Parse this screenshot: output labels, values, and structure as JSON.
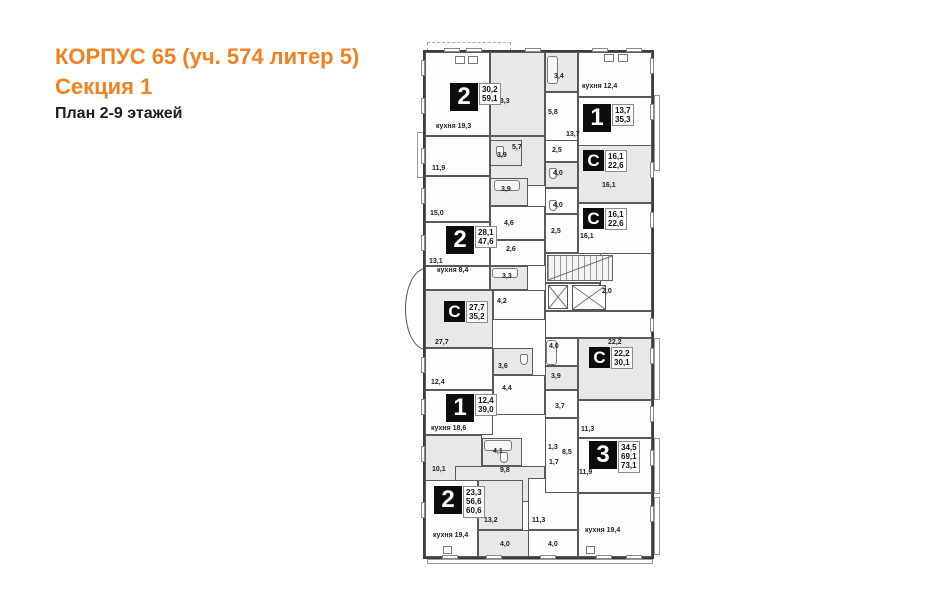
{
  "header": {
    "line1": "КОРПУС 65 (уч. 574 литер 5)",
    "line2": "Секция 1",
    "line3": "План 2-9 этажей",
    "accent_color": "#f48120"
  },
  "plan": {
    "wall_color": "#5a5a5a",
    "fill_gray": "#e8e8e8",
    "fill_white": "#fdfdfd",
    "badge_color": "#0c0c0c",
    "outline": [
      423,
      50,
      231,
      509
    ],
    "bay": [
      405,
      268,
      21,
      82
    ],
    "rooms": [
      [
        425,
        52,
        65,
        84,
        "w",
        "room-kitchen-19-3"
      ],
      [
        490,
        52,
        55,
        84,
        "g",
        "room-18-3"
      ],
      [
        490,
        136,
        55,
        50,
        "g",
        "hall-5-7"
      ],
      [
        425,
        136,
        65,
        40,
        "w",
        "room-11-9"
      ],
      [
        425,
        176,
        65,
        46,
        "w",
        "room-15-0"
      ],
      [
        425,
        222,
        65,
        44,
        "w",
        "room-13-1"
      ],
      [
        425,
        266,
        65,
        24,
        "w",
        "room-kitchen-8-4"
      ],
      [
        490,
        140,
        32,
        26,
        "g",
        "bath-3-9a"
      ],
      [
        490,
        178,
        38,
        28,
        "g",
        "bath-3-9b"
      ],
      [
        490,
        206,
        55,
        34,
        "w",
        "hall-4-6"
      ],
      [
        490,
        240,
        55,
        26,
        "w",
        "room-2-6"
      ],
      [
        490,
        266,
        38,
        24,
        "g",
        "bath-3-3"
      ],
      [
        425,
        290,
        68,
        58,
        "g",
        "studio-27-7"
      ],
      [
        493,
        290,
        52,
        30,
        "w",
        "hall-4-2"
      ],
      [
        493,
        348,
        40,
        27,
        "g",
        "bath-3-6"
      ],
      [
        425,
        348,
        68,
        42,
        "w",
        "room-12-4"
      ],
      [
        425,
        390,
        68,
        45,
        "w",
        "room-39-0"
      ],
      [
        493,
        375,
        52,
        40,
        "w",
        "hall-4-4"
      ],
      [
        425,
        435,
        57,
        50,
        "g",
        "room-10-1"
      ],
      [
        482,
        438,
        40,
        28,
        "g",
        "bath-4-1"
      ],
      [
        455,
        466,
        90,
        36,
        "g",
        "hall-9-8"
      ],
      [
        425,
        480,
        53,
        77,
        "w",
        "room-56-6"
      ],
      [
        478,
        480,
        45,
        50,
        "g",
        "room-13-2"
      ],
      [
        478,
        530,
        68,
        27,
        "g",
        "hall-4-0-left"
      ],
      [
        528,
        478,
        50,
        52,
        "w",
        "room-11-3b"
      ],
      [
        528,
        530,
        50,
        27,
        "w",
        "hall-4-0-right"
      ],
      [
        578,
        493,
        74,
        64,
        "w",
        "room-kitchen-19-4-right"
      ],
      [
        545,
        52,
        33,
        40,
        "g",
        "bath-3-4"
      ],
      [
        578,
        52,
        74,
        45,
        "w",
        "room-kitchen-12-4"
      ],
      [
        545,
        92,
        33,
        64,
        "w",
        "hall-5-8"
      ],
      [
        578,
        97,
        74,
        60,
        "w",
        "room-13-7"
      ],
      [
        545,
        140,
        33,
        22,
        "w",
        "hall-2-5a"
      ],
      [
        545,
        162,
        33,
        26,
        "g",
        "bath-4-0a"
      ],
      [
        578,
        145,
        74,
        58,
        "g",
        "studio-16-1a"
      ],
      [
        545,
        188,
        33,
        26,
        "w",
        "bath-4-0b"
      ],
      [
        545,
        214,
        33,
        39,
        "w",
        "hall-2-5b"
      ],
      [
        578,
        203,
        74,
        52,
        "w",
        "studio-16-1b"
      ],
      [
        545,
        253,
        70,
        30,
        "w",
        "stair-room"
      ],
      [
        600,
        253,
        52,
        58,
        "w",
        "corridor-2-0"
      ],
      [
        545,
        283,
        55,
        28,
        "w",
        "elevator-lobby"
      ],
      [
        545,
        311,
        107,
        27,
        "w",
        "lobby-strip"
      ],
      [
        578,
        338,
        74,
        62,
        "g",
        "studio-22-2"
      ],
      [
        545,
        338,
        33,
        28,
        "w",
        "bath-4-0c"
      ],
      [
        545,
        366,
        33,
        24,
        "g",
        "bath-3-9c"
      ],
      [
        545,
        390,
        33,
        28,
        "w",
        "bath-3-7"
      ],
      [
        578,
        400,
        74,
        38,
        "w",
        "room-11-3a"
      ],
      [
        545,
        418,
        33,
        75,
        "w",
        "hall-8-5"
      ],
      [
        578,
        438,
        74,
        55,
        "w",
        "room-73-1"
      ]
    ],
    "badges": [
      {
        "x": 450,
        "y": 83,
        "ch": "2",
        "small": false,
        "vals": [
          "30,2",
          "59,1"
        ]
      },
      {
        "x": 583,
        "y": 104,
        "ch": "1",
        "small": false,
        "vals": [
          "13,7",
          "35,3"
        ]
      },
      {
        "x": 583,
        "y": 150,
        "ch": "С",
        "small": true,
        "vals": [
          "16,1",
          "22,6"
        ]
      },
      {
        "x": 583,
        "y": 208,
        "ch": "С",
        "small": true,
        "vals": [
          "16,1",
          "22,6"
        ]
      },
      {
        "x": 446,
        "y": 226,
        "ch": "2",
        "small": false,
        "vals": [
          "28,1",
          "47,6"
        ]
      },
      {
        "x": 444,
        "y": 301,
        "ch": "С",
        "small": true,
        "vals": [
          "27,7",
          "35,2"
        ]
      },
      {
        "x": 589,
        "y": 347,
        "ch": "С",
        "small": true,
        "vals": [
          "22,2",
          "30,1"
        ]
      },
      {
        "x": 446,
        "y": 394,
        "ch": "1",
        "small": false,
        "vals": [
          "12,4",
          "39,0"
        ]
      },
      {
        "x": 589,
        "y": 441,
        "ch": "3",
        "small": false,
        "vals": [
          "34,5",
          "69,1",
          "73,1"
        ]
      },
      {
        "x": 434,
        "y": 486,
        "ch": "2",
        "small": false,
        "vals": [
          "23,3",
          "56,6",
          "60,6"
        ]
      }
    ],
    "labels": [
      [
        436,
        123,
        "кухня 19,3"
      ],
      [
        496,
        98,
        "18,3"
      ],
      [
        512,
        144,
        "5,7"
      ],
      [
        432,
        165,
        "11,9"
      ],
      [
        430,
        210,
        "15,0"
      ],
      [
        429,
        258,
        "13,1"
      ],
      [
        437,
        267,
        "кухня 8,4"
      ],
      [
        497,
        152,
        "3,9"
      ],
      [
        501,
        186,
        "3,9"
      ],
      [
        504,
        220,
        "4,6"
      ],
      [
        506,
        246,
        "2,6"
      ],
      [
        502,
        273,
        "3,3"
      ],
      [
        497,
        298,
        "4,2"
      ],
      [
        435,
        339,
        "27,7"
      ],
      [
        498,
        363,
        "3,6"
      ],
      [
        431,
        379,
        "12,4"
      ],
      [
        431,
        425,
        "кухня 18,6"
      ],
      [
        502,
        385,
        "4,4"
      ],
      [
        432,
        466,
        "10,1"
      ],
      [
        493,
        448,
        "4,1"
      ],
      [
        500,
        467,
        "9,8"
      ],
      [
        433,
        532,
        "кухня 19,4"
      ],
      [
        484,
        517,
        "13,2"
      ],
      [
        500,
        541,
        "4,0"
      ],
      [
        532,
        517,
        "11,3"
      ],
      [
        548,
        541,
        "4,0"
      ],
      [
        585,
        527,
        "кухня 19,4"
      ],
      [
        554,
        73,
        "3,4"
      ],
      [
        582,
        83,
        "кухня 12,4"
      ],
      [
        548,
        109,
        "5,8"
      ],
      [
        566,
        131,
        "13,7"
      ],
      [
        552,
        147,
        "2,5"
      ],
      [
        553,
        170,
        "4,0"
      ],
      [
        602,
        182,
        "16,1"
      ],
      [
        553,
        202,
        "4,0"
      ],
      [
        551,
        228,
        "2,5"
      ],
      [
        580,
        233,
        "16,1"
      ],
      [
        602,
        288,
        "2,0"
      ],
      [
        608,
        339,
        "22,2"
      ],
      [
        549,
        343,
        "4,0"
      ],
      [
        551,
        373,
        "3,9"
      ],
      [
        555,
        403,
        "3,7"
      ],
      [
        581,
        426,
        "11,3"
      ],
      [
        548,
        444,
        "1,3"
      ],
      [
        562,
        449,
        "8,5"
      ],
      [
        549,
        459,
        "1,7"
      ],
      [
        579,
        469,
        "11,9"
      ]
    ],
    "stairs": [
      547,
      255,
      66,
      26
    ],
    "elevators": [
      [
        548,
        285,
        20,
        24
      ],
      [
        572,
        285,
        34,
        25
      ]
    ],
    "balconies": [
      [
        427,
        42,
        84,
        9,
        true
      ],
      [
        654,
        95,
        6,
        76,
        false
      ],
      [
        654,
        338,
        6,
        62,
        false
      ],
      [
        654,
        438,
        6,
        56,
        false
      ],
      [
        654,
        497,
        6,
        58,
        false
      ],
      [
        427,
        559,
        226,
        5,
        false
      ],
      [
        417,
        132,
        8,
        46,
        false
      ]
    ],
    "windows": [
      [
        421,
        60,
        4,
        16
      ],
      [
        421,
        98,
        4,
        16
      ],
      [
        421,
        148,
        4,
        16
      ],
      [
        421,
        188,
        4,
        16
      ],
      [
        421,
        235,
        4,
        16
      ],
      [
        421,
        357,
        4,
        16
      ],
      [
        421,
        399,
        4,
        16
      ],
      [
        421,
        446,
        4,
        16
      ],
      [
        421,
        502,
        4,
        16
      ],
      [
        650,
        58,
        4,
        16
      ],
      [
        650,
        104,
        4,
        16
      ],
      [
        650,
        162,
        4,
        16
      ],
      [
        650,
        212,
        4,
        16
      ],
      [
        650,
        318,
        4,
        14
      ],
      [
        650,
        348,
        4,
        16
      ],
      [
        650,
        406,
        4,
        16
      ],
      [
        650,
        450,
        4,
        16
      ],
      [
        650,
        506,
        4,
        16
      ],
      [
        444,
        48,
        16,
        4
      ],
      [
        466,
        48,
        16,
        4
      ],
      [
        525,
        48,
        16,
        4
      ],
      [
        592,
        48,
        16,
        4
      ],
      [
        626,
        48,
        16,
        4
      ],
      [
        442,
        555,
        16,
        4
      ],
      [
        486,
        555,
        16,
        4
      ],
      [
        540,
        555,
        16,
        4
      ],
      [
        596,
        555,
        16,
        4
      ],
      [
        626,
        555,
        16,
        4
      ]
    ],
    "fixtures": [
      [
        "tub",
        494,
        180,
        26,
        11
      ],
      [
        "tub",
        492,
        268,
        26,
        10
      ],
      [
        "tub",
        484,
        440,
        28,
        11
      ],
      [
        "tub",
        547,
        56,
        11,
        28
      ],
      [
        "tub",
        546,
        340,
        11,
        25
      ],
      [
        "wc",
        496,
        146,
        8,
        11
      ],
      [
        "wc",
        549,
        168,
        8,
        11
      ],
      [
        "wc",
        549,
        200,
        8,
        11
      ],
      [
        "wc",
        520,
        354,
        8,
        11
      ],
      [
        "wc",
        500,
        452,
        8,
        11
      ],
      [
        "appl",
        455,
        56,
        10,
        8
      ],
      [
        "appl",
        468,
        56,
        10,
        8
      ],
      [
        "appl",
        604,
        54,
        10,
        8
      ],
      [
        "appl",
        618,
        54,
        10,
        8
      ],
      [
        "appl",
        443,
        546,
        9,
        8
      ],
      [
        "appl",
        586,
        546,
        9,
        8
      ]
    ]
  }
}
